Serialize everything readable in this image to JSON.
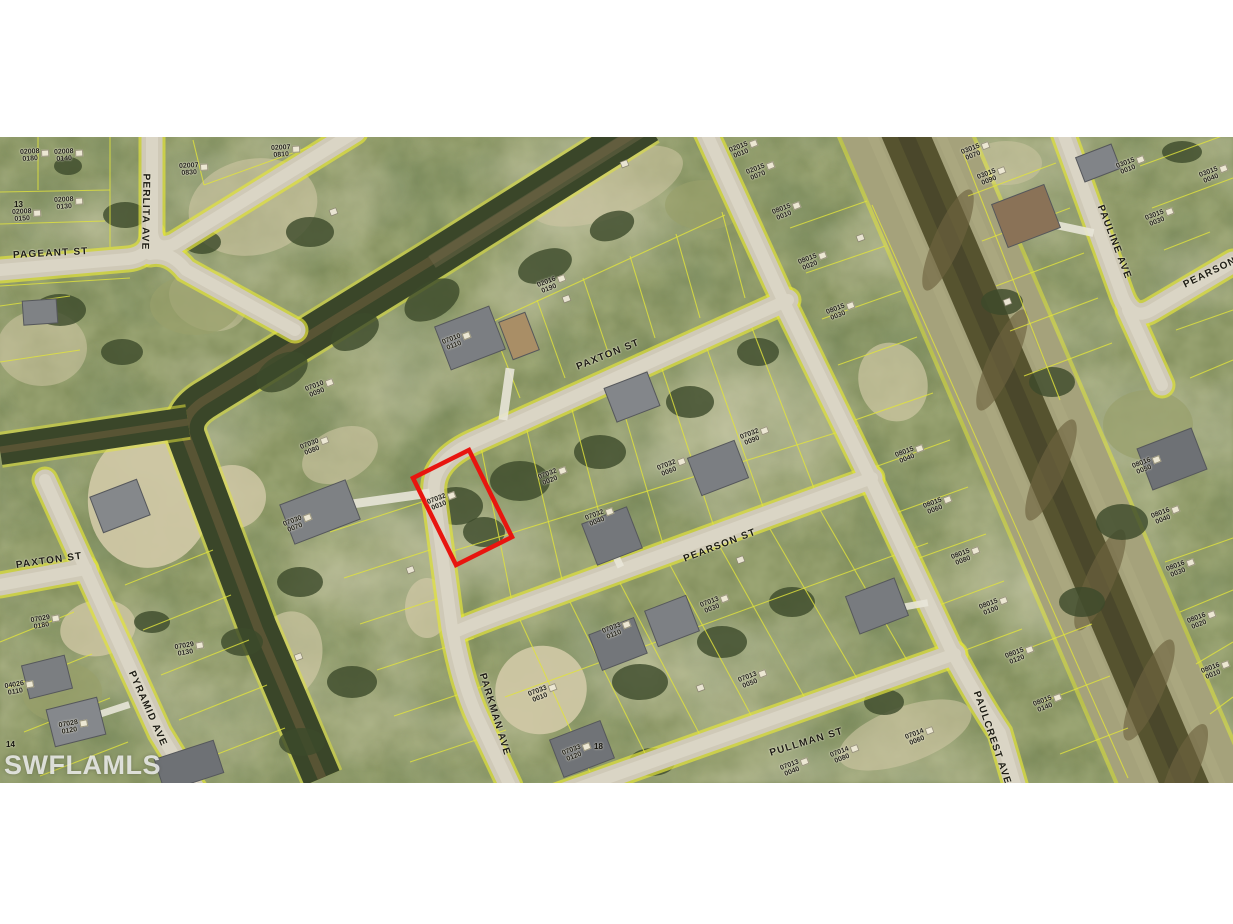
{
  "watermark": "SWFLAMLS",
  "map": {
    "colors": {
      "veg": "#73804f",
      "road": "#cfc9b7",
      "roadc": "#dad5c5",
      "bank": "#a5a27b",
      "water": "#56532f",
      "lot": "#e2e43c",
      "hl": "#e8150f",
      "lbl": "#1c1b14"
    },
    "highlight_parcel": "07032 0010",
    "street_labels": [
      {
        "text": "PAGEANT ST",
        "x": 13,
        "y": 250,
        "rot": -3
      },
      {
        "text": "PERLITA AVE",
        "x": 146,
        "y": 168,
        "rot": 91
      },
      {
        "text": "PAXTON ST",
        "x": 16,
        "y": 560,
        "rot": -8
      },
      {
        "text": "PYRAMID AVE",
        "x": 131,
        "y": 666,
        "rot": 66
      },
      {
        "text": "PARKMAN AVE",
        "x": 482,
        "y": 668,
        "rot": 73
      },
      {
        "text": "PAXTON ST",
        "x": 577,
        "y": 362,
        "rot": -22
      },
      {
        "text": "PEARSON ST",
        "x": 684,
        "y": 554,
        "rot": -21
      },
      {
        "text": "PULLMAN ST",
        "x": 770,
        "y": 748,
        "rot": -17
      },
      {
        "text": "PAULINE AVE",
        "x": 1100,
        "y": 200,
        "rot": 69
      },
      {
        "text": "PEARSON ST",
        "x": 1184,
        "y": 280,
        "rot": -26
      },
      {
        "text": "PAULCREST AVE",
        "x": 976,
        "y": 686,
        "rot": 71
      }
    ],
    "parcel_labels": [
      {
        "l1": "02008",
        "l2": "0180",
        "x": 30,
        "y": 156,
        "rot": -3
      },
      {
        "l1": "02008",
        "l2": "0140",
        "x": 64,
        "y": 156,
        "rot": -3
      },
      {
        "l1": "02008",
        "l2": "0150",
        "x": 22,
        "y": 216,
        "rot": -3
      },
      {
        "l1": "02008",
        "l2": "0130",
        "x": 64,
        "y": 204,
        "rot": -3
      },
      {
        "l1": "02007",
        "l2": "0830",
        "x": 189,
        "y": 170,
        "rot": -3
      },
      {
        "l1": "02007",
        "l2": "0810",
        "x": 281,
        "y": 152,
        "rot": -3
      },
      {
        "l1": "02015",
        "l2": "0010",
        "x": 740,
        "y": 151,
        "rot": -21
      },
      {
        "l1": "02015",
        "l2": "0070",
        "x": 757,
        "y": 173,
        "rot": -21
      },
      {
        "l1": "02016",
        "l2": "0190",
        "x": 548,
        "y": 286,
        "rot": -21
      },
      {
        "l1": "07010",
        "l2": "0110",
        "x": 453,
        "y": 343,
        "rot": -21
      },
      {
        "l1": "07010",
        "l2": "0090",
        "x": 316,
        "y": 390,
        "rot": -21
      },
      {
        "l1": "08015",
        "l2": "0010",
        "x": 783,
        "y": 213,
        "rot": -21
      },
      {
        "l1": "08015",
        "l2": "0020",
        "x": 809,
        "y": 263,
        "rot": -21
      },
      {
        "l1": "08015",
        "l2": "0030",
        "x": 837,
        "y": 313,
        "rot": -21
      },
      {
        "l1": "08015",
        "l2": "0040",
        "x": 906,
        "y": 456,
        "rot": -21
      },
      {
        "l1": "08015",
        "l2": "0060",
        "x": 934,
        "y": 507,
        "rot": -21
      },
      {
        "l1": "08015",
        "l2": "0080",
        "x": 962,
        "y": 558,
        "rot": -21
      },
      {
        "l1": "08015",
        "l2": "0100",
        "x": 990,
        "y": 608,
        "rot": -21
      },
      {
        "l1": "08015",
        "l2": "0120",
        "x": 1016,
        "y": 657,
        "rot": -21
      },
      {
        "l1": "08015",
        "l2": "0140",
        "x": 1044,
        "y": 705,
        "rot": -21
      },
      {
        "l1": "03015",
        "l2": "0070",
        "x": 972,
        "y": 153,
        "rot": -21
      },
      {
        "l1": "03015",
        "l2": "0090",
        "x": 988,
        "y": 178,
        "rot": -21
      },
      {
        "l1": "03015",
        "l2": "0010",
        "x": 1127,
        "y": 167,
        "rot": -21
      },
      {
        "l1": "03015",
        "l2": "0040",
        "x": 1210,
        "y": 176,
        "rot": -21
      },
      {
        "l1": "03015",
        "l2": "0030",
        "x": 1156,
        "y": 219,
        "rot": -21
      },
      {
        "l1": "08016",
        "l2": "0050",
        "x": 1143,
        "y": 467,
        "rot": -21
      },
      {
        "l1": "08016",
        "l2": "0040",
        "x": 1162,
        "y": 517,
        "rot": -21
      },
      {
        "l1": "08016",
        "l2": "0030",
        "x": 1177,
        "y": 570,
        "rot": -21
      },
      {
        "l1": "08016",
        "l2": "0020",
        "x": 1198,
        "y": 622,
        "rot": -21
      },
      {
        "l1": "08016",
        "l2": "0010",
        "x": 1212,
        "y": 672,
        "rot": -21
      },
      {
        "l1": "07032",
        "l2": "0010",
        "x": 438,
        "y": 503,
        "rot": -21
      },
      {
        "l1": "07032",
        "l2": "0020",
        "x": 549,
        "y": 478,
        "rot": -21
      },
      {
        "l1": "07032",
        "l2": "0040",
        "x": 596,
        "y": 519,
        "rot": -21
      },
      {
        "l1": "07032",
        "l2": "0060",
        "x": 668,
        "y": 469,
        "rot": -21
      },
      {
        "l1": "07032",
        "l2": "0090",
        "x": 751,
        "y": 438,
        "rot": -21
      },
      {
        "l1": "07030",
        "l2": "0080",
        "x": 311,
        "y": 448,
        "rot": -21
      },
      {
        "l1": "07030",
        "l2": "0070",
        "x": 294,
        "y": 525,
        "rot": -21
      },
      {
        "l1": "07033",
        "l2": "0010",
        "x": 539,
        "y": 695,
        "rot": -21
      },
      {
        "l1": "07033",
        "l2": "0110",
        "x": 613,
        "y": 632,
        "rot": -21
      },
      {
        "l1": "07033",
        "l2": "0120",
        "x": 573,
        "y": 754,
        "rot": -21
      },
      {
        "l1": "07013",
        "l2": "0030",
        "x": 711,
        "y": 606,
        "rot": -21
      },
      {
        "l1": "07013",
        "l2": "0050",
        "x": 749,
        "y": 681,
        "rot": -21
      },
      {
        "l1": "07013",
        "l2": "0040",
        "x": 791,
        "y": 769,
        "rot": -21
      },
      {
        "l1": "07014",
        "l2": "0080",
        "x": 841,
        "y": 756,
        "rot": -21
      },
      {
        "l1": "07014",
        "l2": "0060",
        "x": 916,
        "y": 738,
        "rot": -21
      },
      {
        "l1": "07029",
        "l2": "0180",
        "x": 41,
        "y": 623,
        "rot": -10
      },
      {
        "l1": "07029",
        "l2": "0130",
        "x": 185,
        "y": 650,
        "rot": -10
      },
      {
        "l1": "04026",
        "l2": "0110",
        "x": 15,
        "y": 689,
        "rot": -10
      },
      {
        "l1": "07028",
        "l2": "0120",
        "x": 69,
        "y": 728,
        "rot": -10
      }
    ],
    "lot_numbers": [
      {
        "text": "13",
        "x": 14,
        "y": 200
      },
      {
        "text": "14",
        "x": 6,
        "y": 740
      },
      {
        "text": "18",
        "x": 594,
        "y": 742
      }
    ]
  }
}
